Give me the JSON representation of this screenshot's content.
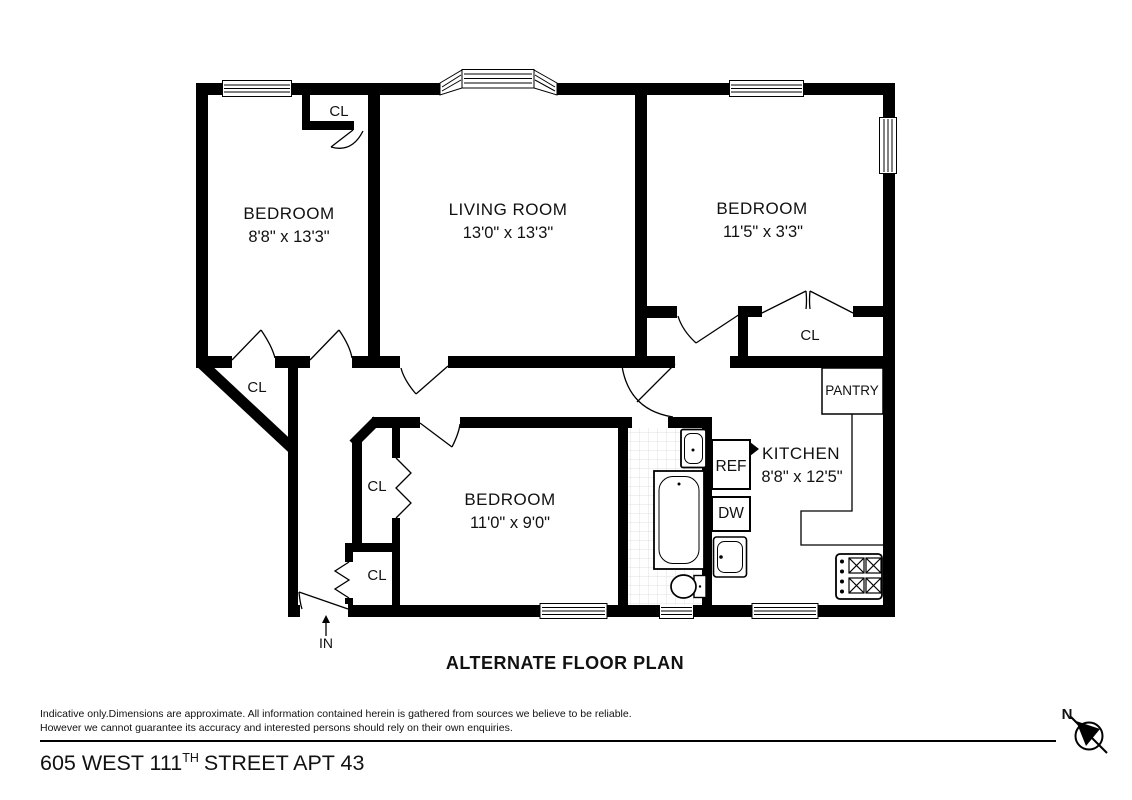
{
  "title": "ALTERNATE FLOOR PLAN",
  "rooms": {
    "bedroom_top_left": {
      "name": "BEDROOM",
      "dimensions": "8'8\" x 13'3\""
    },
    "living_room": {
      "name": "LIVING ROOM",
      "dimensions": "13'0\" x 13'3\""
    },
    "bedroom_top_right": {
      "name": "BEDROOM",
      "dimensions": "11'5\" x 3'3\""
    },
    "bedroom_bottom": {
      "name": "BEDROOM",
      "dimensions": "11'0\" x 9'0\""
    },
    "kitchen": {
      "name": "KITCHEN",
      "dimensions": "8'8\" x 12'5\""
    },
    "pantry": {
      "name": "PANTRY"
    }
  },
  "labels": {
    "closet": "CL",
    "refrigerator": "REF",
    "dishwasher": "DW"
  },
  "entry": {
    "label": "IN"
  },
  "compass": {
    "north_label": "N"
  },
  "disclaimer": {
    "line1": "Indicative only.Dimensions are approximate. All information contained herein is gathered from sources we believe to be reliable.",
    "line2": "However we cannot guarantee its accuracy and interested persons should rely on their own enquiries."
  },
  "address": {
    "prefix": "605 WEST 111",
    "superscript": "TH",
    "suffix": "STREET APT 43"
  },
  "colors": {
    "wall": "#000000",
    "background": "#ffffff",
    "tile_line": "#e0e0e0"
  }
}
